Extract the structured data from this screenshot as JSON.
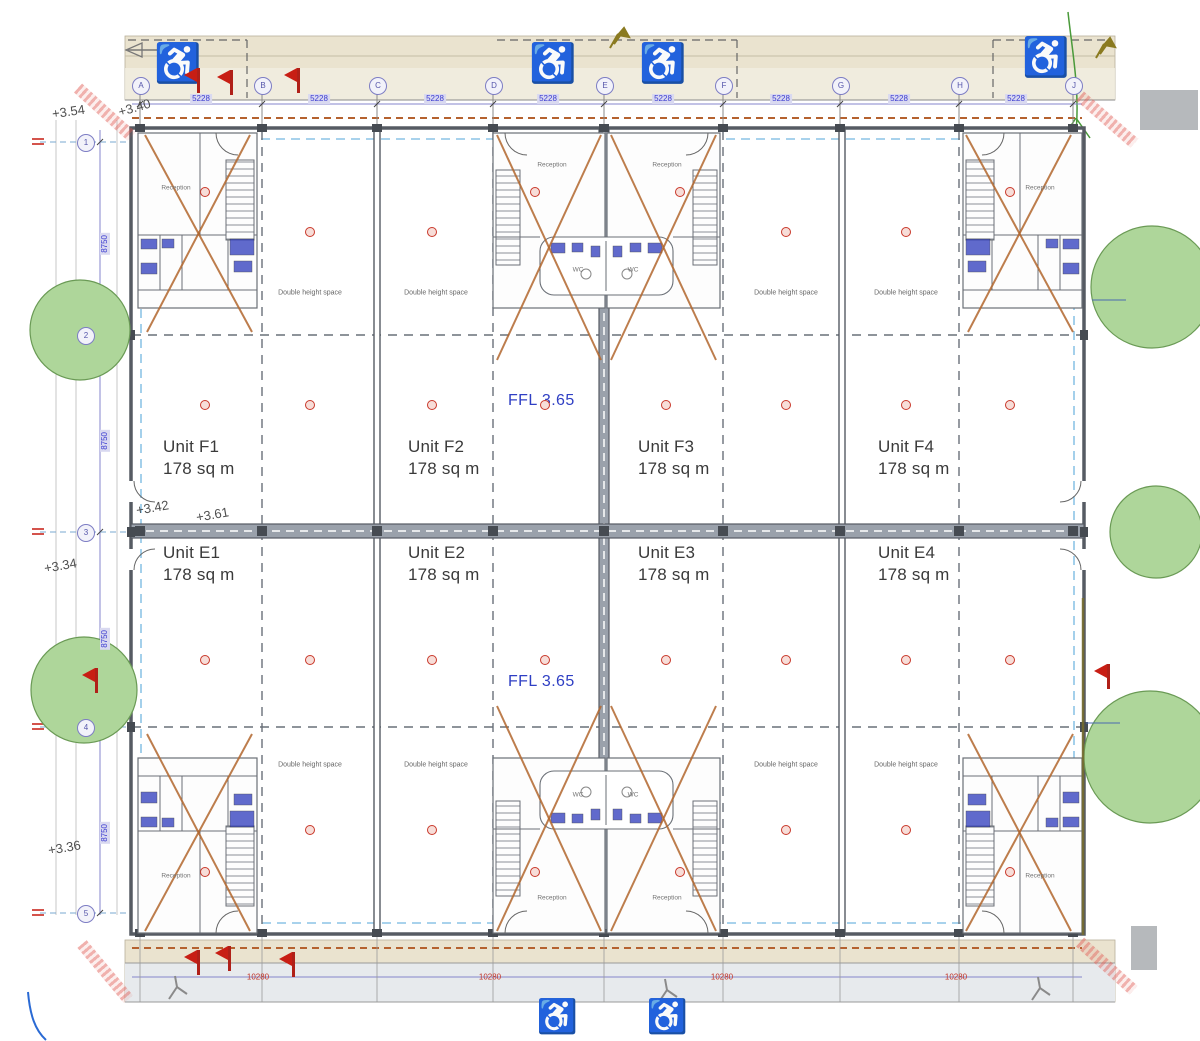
{
  "labels": {
    "reception": "Reception",
    "wc": "WC",
    "double_height": "Double height space",
    "ffl": "FFL 3.65"
  },
  "units": [
    {
      "name": "Unit F1",
      "area": "178 sq m"
    },
    {
      "name": "Unit F2",
      "area": "178 sq m"
    },
    {
      "name": "Unit F3",
      "area": "178 sq m"
    },
    {
      "name": "Unit F4",
      "area": "178 sq m"
    },
    {
      "name": "Unit E1",
      "area": "178 sq m"
    },
    {
      "name": "Unit E2",
      "area": "178 sq m"
    },
    {
      "name": "Unit E3",
      "area": "178 sq m"
    },
    {
      "name": "Unit E4",
      "area": "178 sq m"
    }
  ],
  "spot_levels": [
    "+3.54",
    "+3.40",
    "+3.42",
    "+3.61",
    "+3.34",
    "+3.36"
  ],
  "grid": {
    "top_labels": [
      "A",
      "B",
      "C",
      "D",
      "E",
      "F",
      "G",
      "H",
      "J"
    ],
    "left_labels": [
      "1",
      "2",
      "3",
      "4",
      "5"
    ]
  },
  "dimensions": {
    "bay_width": "5228",
    "side_bay": "8750",
    "bottom_bay": "10280"
  },
  "icons": {
    "wheelchair_glyph": "♿"
  },
  "colors": {
    "band_beige": "#eae3cf",
    "wall_gray": "#565b63",
    "grid_blue": "#7d7dc4",
    "dim_blue": "#3b3bd0",
    "ffl_blue": "#2f3fc4",
    "marker_red": "#c9382a",
    "brace_orange": "#b2672e",
    "tree_green": "#aed69a"
  }
}
